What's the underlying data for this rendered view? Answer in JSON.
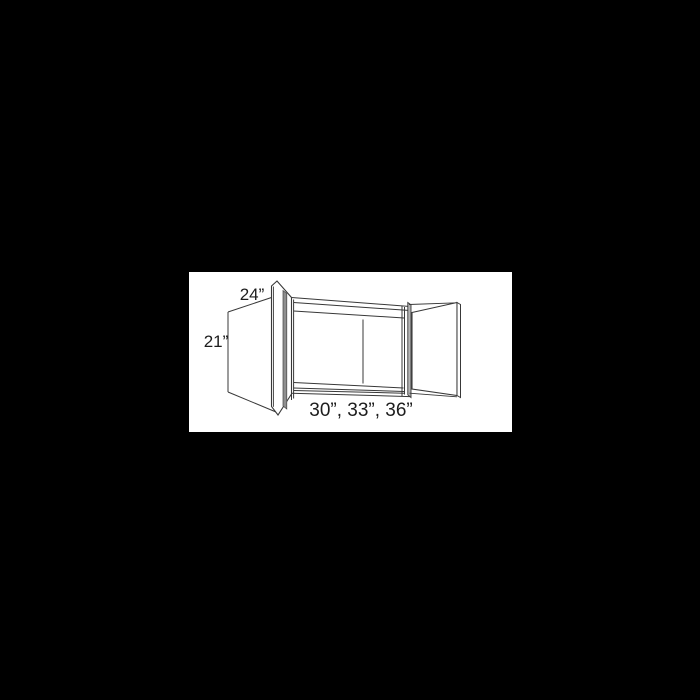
{
  "diagram": {
    "kind": "wall-cabinet-line-drawing",
    "description": "Technical line drawing of a two-door wall cabinet shown open, with dimension labels",
    "labels": {
      "depth": "24”",
      "height": "21”",
      "width_options": "30”, 33”, 36”"
    },
    "dimensions": {
      "depth_inches": 24,
      "height_inches": 21,
      "width_options_inches": [
        30,
        33,
        36
      ]
    },
    "colors": {
      "page_background": "#000000",
      "drawing_background": "#ffffff",
      "line": "#383838",
      "door_edge_shade": "#8f8f8f",
      "cabinet_edge_shade": "#b5b5b5",
      "text": "#1d1d1d"
    }
  }
}
